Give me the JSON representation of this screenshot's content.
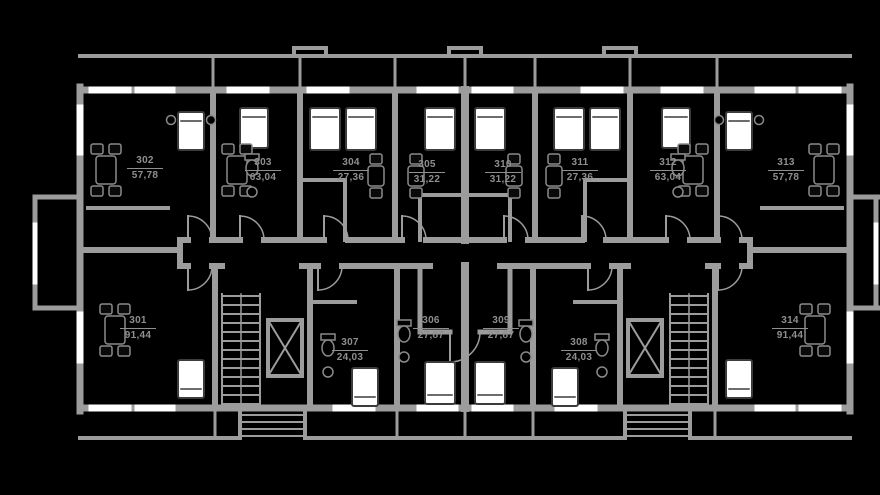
{
  "plan_title": "floor-plan",
  "colors": {
    "background": "#000000",
    "wall": "#9c9c9c",
    "window": "#ffffff",
    "fixture": "#8a8a8a",
    "bed_fill": "#ffffff",
    "label": "#8f8f8f"
  },
  "units": [
    {
      "number": "302",
      "area": "57,78"
    },
    {
      "number": "303",
      "area": "63,04"
    },
    {
      "number": "304",
      "area": "27,36"
    },
    {
      "number": "305",
      "area": "31,22"
    },
    {
      "number": "310",
      "area": "31,22"
    },
    {
      "number": "311",
      "area": "27,36"
    },
    {
      "number": "312",
      "area": "63,04"
    },
    {
      "number": "313",
      "area": "57,78"
    },
    {
      "number": "301",
      "area": "91,44"
    },
    {
      "number": "307",
      "area": "24,03"
    },
    {
      "number": "306",
      "area": "27,87"
    },
    {
      "number": "309",
      "area": "27,87"
    },
    {
      "number": "308",
      "area": "24,03"
    },
    {
      "number": "314",
      "area": "91,44"
    }
  ]
}
